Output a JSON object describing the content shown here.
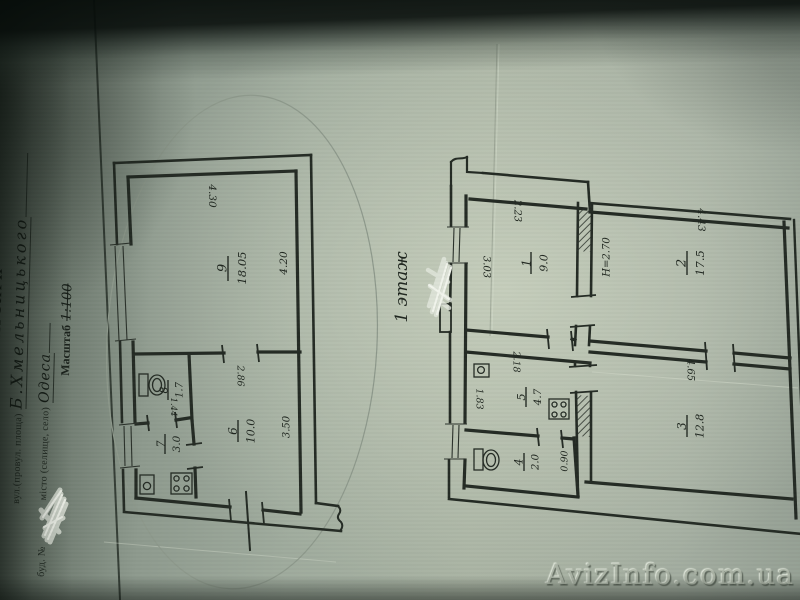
{
  "form": {
    "title": "ПЛАН КВАРТИРИ",
    "street_line": {
      "label": "вул.(провул. площа)",
      "value": "Б.Хмельницького"
    },
    "building_line": {
      "label": "буд. №",
      "value_redacted": ""
    },
    "city_line": {
      "label": "місто (селище, село)",
      "value": "Одеса"
    },
    "scale_line": {
      "label": "Масштаб",
      "value": "1:100"
    }
  },
  "floor_note": "1 этаж",
  "watermark": "AvizInfo.com.ua",
  "left_plan": {
    "rooms": [
      {
        "number": "9",
        "area": "18.05"
      },
      {
        "number": "6",
        "area": "10.0"
      },
      {
        "number": "7",
        "area": "3.0"
      },
      {
        "number": "8",
        "area": "1.7"
      }
    ],
    "dims": {
      "room9_width": "4.30",
      "room9_depth": "4.20",
      "room6_width": "2.86",
      "room6_depth": "3.50",
      "room7_width": "1.44"
    }
  },
  "right_plan": {
    "rooms": [
      {
        "number": "1",
        "area": "9.0"
      },
      {
        "number": "2",
        "area": "17.5"
      },
      {
        "number": "3",
        "area": "12.8"
      },
      {
        "number": "5",
        "area": "4.7"
      },
      {
        "number": "4",
        "area": "2.0"
      }
    ],
    "dims": {
      "room1_width": "2.23",
      "room1_depth": "3.03",
      "room2_width": "4.43",
      "room3_width": "4.65",
      "room5_width": "2.18",
      "room5_depth": "1.83",
      "room4_width": "0.90"
    },
    "ceiling_height": "H=2.70"
  }
}
